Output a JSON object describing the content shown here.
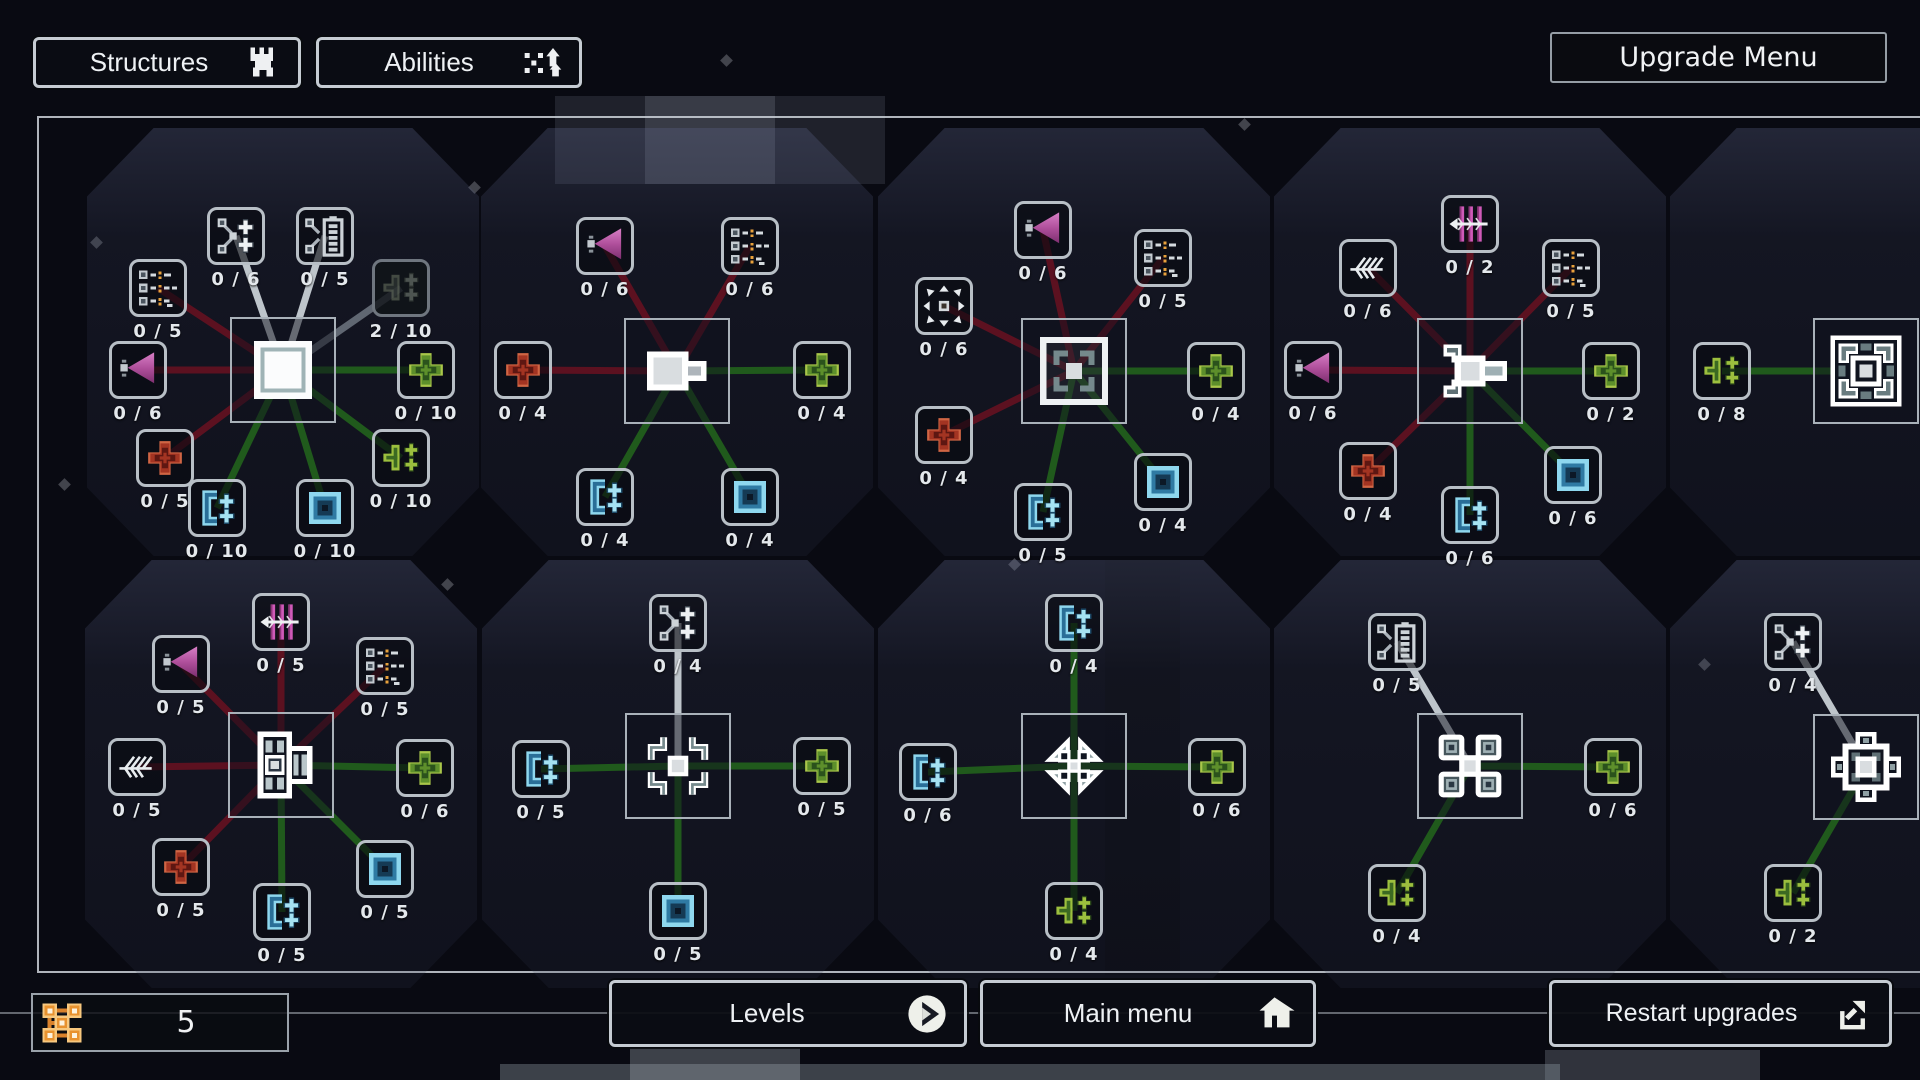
{
  "top_bar": {
    "structures_label": "Structures",
    "structures_icon": "castle",
    "abilities_label": "Abilities",
    "abilities_icon": "abilities",
    "upgrade_menu_label": "Upgrade Menu"
  },
  "bottom_bar": {
    "points_value": "5",
    "points_icon": "points",
    "levels_label": "Levels",
    "levels_icon": "play",
    "main_menu_label": "Main menu",
    "main_menu_icon": "home",
    "restart_label": "Restart upgrades",
    "restart_icon": "restart"
  },
  "colors": {
    "line_red": "#5c1120",
    "line_green": "#205a1c",
    "line_gray": "#d2d8de",
    "accent_orange": "#e8922f",
    "plus_green": "#a9c64a",
    "plus_red": "#d06544",
    "blue": "#8ed7ee",
    "magenta": "#c45fb0"
  },
  "clusters": [
    {
      "id": "wall",
      "icon": "wall",
      "cx": 283,
      "cy": 370,
      "nodes": [
        {
          "icon": "stat-list",
          "count": "0 / 5",
          "x": 158,
          "y": 288,
          "line": "red"
        },
        {
          "icon": "branch-plus",
          "count": "0 / 6",
          "x": 236,
          "y": 236,
          "line": "white"
        },
        {
          "icon": "branch-battery",
          "count": "0 / 5",
          "x": 325,
          "y": 236,
          "line": "white"
        },
        {
          "icon": "plus-faded",
          "count": "2 / 10",
          "x": 401,
          "y": 288,
          "line": "graydim",
          "dim": true
        },
        {
          "icon": "attack-cone",
          "count": "0 / 6",
          "x": 138,
          "y": 370,
          "line": "red"
        },
        {
          "icon": "plus-green",
          "count": "0 / 10",
          "x": 426,
          "y": 370,
          "line": "green"
        },
        {
          "icon": "plus-red",
          "count": "0 / 5",
          "x": 165,
          "y": 458,
          "line": "red"
        },
        {
          "icon": "multi-plus-green",
          "count": "0 / 10",
          "x": 401,
          "y": 458,
          "line": "green"
        },
        {
          "icon": "blue-bracket-plus",
          "count": "0 / 10",
          "x": 217,
          "y": 508,
          "line": "green"
        },
        {
          "icon": "blue-square",
          "count": "0 / 10",
          "x": 325,
          "y": 508,
          "line": "green"
        }
      ]
    },
    {
      "id": "gate",
      "icon": "gate",
      "cx": 677,
      "cy": 371,
      "nodes": [
        {
          "icon": "attack-cone",
          "count": "0 / 6",
          "x": 605,
          "y": 246,
          "line": "red"
        },
        {
          "icon": "stat-list",
          "count": "0 / 6",
          "x": 750,
          "y": 246,
          "line": "red"
        },
        {
          "icon": "plus-red",
          "count": "0 / 4",
          "x": 523,
          "y": 370,
          "line": "red"
        },
        {
          "icon": "plus-green",
          "count": "0 / 4",
          "x": 822,
          "y": 370,
          "line": "green"
        },
        {
          "icon": "blue-bracket-plus",
          "count": "0 / 4",
          "x": 605,
          "y": 497,
          "line": "green"
        },
        {
          "icon": "blue-square",
          "count": "0 / 4",
          "x": 750,
          "y": 497,
          "line": "green"
        }
      ]
    },
    {
      "id": "trap",
      "icon": "trap",
      "cx": 1074,
      "cy": 371,
      "nodes": [
        {
          "icon": "attack-cone",
          "count": "0 / 6",
          "x": 1043,
          "y": 230,
          "line": "red"
        },
        {
          "icon": "stat-list",
          "count": "0 / 5",
          "x": 1163,
          "y": 258,
          "line": "red"
        },
        {
          "icon": "range-arrows",
          "count": "0 / 6",
          "x": 944,
          "y": 306,
          "line": "red"
        },
        {
          "icon": "plus-red",
          "count": "0 / 4",
          "x": 944,
          "y": 435,
          "line": "red"
        },
        {
          "icon": "plus-green",
          "count": "0 / 4",
          "x": 1216,
          "y": 371,
          "line": "green"
        },
        {
          "icon": "blue-bracket-plus",
          "count": "0 / 5",
          "x": 1043,
          "y": 512,
          "line": "green"
        },
        {
          "icon": "blue-square",
          "count": "0 / 4",
          "x": 1163,
          "y": 482,
          "line": "green"
        }
      ]
    },
    {
      "id": "turret",
      "icon": "turret",
      "cx": 1470,
      "cy": 371,
      "nodes": [
        {
          "icon": "claw-strike",
          "count": "0 / 2",
          "x": 1470,
          "y": 224,
          "line": "red"
        },
        {
          "icon": "pierce-feather",
          "count": "0 / 6",
          "x": 1368,
          "y": 268,
          "line": "red"
        },
        {
          "icon": "stat-list",
          "count": "0 / 5",
          "x": 1571,
          "y": 268,
          "line": "red"
        },
        {
          "icon": "attack-cone",
          "count": "0 / 6",
          "x": 1313,
          "y": 370,
          "line": "red"
        },
        {
          "icon": "plus-green",
          "count": "0 / 2",
          "x": 1611,
          "y": 371,
          "line": "green"
        },
        {
          "icon": "plus-red",
          "count": "0 / 4",
          "x": 1368,
          "y": 471,
          "line": "red"
        },
        {
          "icon": "blue-bracket-plus",
          "count": "0 / 6",
          "x": 1470,
          "y": 515,
          "line": "green"
        },
        {
          "icon": "blue-square",
          "count": "0 / 6",
          "x": 1573,
          "y": 475,
          "line": "green"
        }
      ]
    },
    {
      "id": "fortress",
      "icon": "fortress",
      "cx": 1866,
      "cy": 371,
      "nodes": [
        {
          "icon": "multi-plus-green",
          "count": "0 / 8",
          "x": 1722,
          "y": 371,
          "line": "green"
        }
      ]
    },
    {
      "id": "ballista",
      "icon": "ballista",
      "cx": 281,
      "cy": 765,
      "nodes": [
        {
          "icon": "claw-strike",
          "count": "0 / 5",
          "x": 281,
          "y": 622,
          "line": "red"
        },
        {
          "icon": "attack-cone",
          "count": "0 / 5",
          "x": 181,
          "y": 664,
          "line": "red"
        },
        {
          "icon": "stat-list",
          "count": "0 / 5",
          "x": 385,
          "y": 666,
          "line": "red"
        },
        {
          "icon": "pierce-feather",
          "count": "0 / 5",
          "x": 137,
          "y": 767,
          "line": "red"
        },
        {
          "icon": "plus-green",
          "count": "0 / 6",
          "x": 425,
          "y": 768,
          "line": "green"
        },
        {
          "icon": "plus-red",
          "count": "0 / 5",
          "x": 181,
          "y": 867,
          "line": "red"
        },
        {
          "icon": "blue-bracket-plus",
          "count": "0 / 5",
          "x": 282,
          "y": 912,
          "line": "green"
        },
        {
          "icon": "blue-square",
          "count": "0 / 5",
          "x": 385,
          "y": 869,
          "line": "green"
        }
      ]
    },
    {
      "id": "frost-cross",
      "icon": "frost-cross",
      "cx": 678,
      "cy": 766,
      "nodes": [
        {
          "icon": "branch-plus",
          "count": "0 / 4",
          "x": 678,
          "y": 623,
          "line": "white"
        },
        {
          "icon": "blue-bracket-plus",
          "count": "0 / 5",
          "x": 541,
          "y": 769,
          "line": "green"
        },
        {
          "icon": "plus-green",
          "count": "0 / 5",
          "x": 822,
          "y": 766,
          "line": "green"
        },
        {
          "icon": "blue-square",
          "count": "0 / 5",
          "x": 678,
          "y": 911,
          "line": "green"
        }
      ]
    },
    {
      "id": "fan-blades",
      "icon": "fan-blades",
      "cx": 1074,
      "cy": 766,
      "nodes": [
        {
          "icon": "blue-bracket-plus",
          "count": "0 / 4",
          "x": 1074,
          "y": 623,
          "line": "green"
        },
        {
          "icon": "blue-bracket-plus",
          "count": "0 / 6",
          "x": 928,
          "y": 772,
          "line": "green"
        },
        {
          "icon": "plus-green",
          "count": "0 / 6",
          "x": 1217,
          "y": 767,
          "line": "green"
        },
        {
          "icon": "multi-plus-green",
          "count": "0 / 4",
          "x": 1074,
          "y": 911,
          "line": "green"
        }
      ]
    },
    {
      "id": "cross-structure",
      "icon": "cross-structure",
      "cx": 1470,
      "cy": 766,
      "nodes": [
        {
          "icon": "branch-battery",
          "count": "0 / 5",
          "x": 1397,
          "y": 642,
          "line": "white"
        },
        {
          "icon": "plus-green",
          "count": "0 / 6",
          "x": 1613,
          "y": 767,
          "line": "green"
        },
        {
          "icon": "multi-plus-green",
          "count": "0 / 4",
          "x": 1397,
          "y": 893,
          "line": "green"
        }
      ]
    },
    {
      "id": "citadel",
      "icon": "citadel",
      "cx": 1866,
      "cy": 767,
      "nodes": [
        {
          "icon": "branch-plus",
          "count": "0 / 4",
          "x": 1793,
          "y": 642,
          "line": "white"
        },
        {
          "icon": "multi-plus-green",
          "count": "0 / 2",
          "x": 1793,
          "y": 893,
          "line": "green"
        }
      ]
    }
  ]
}
